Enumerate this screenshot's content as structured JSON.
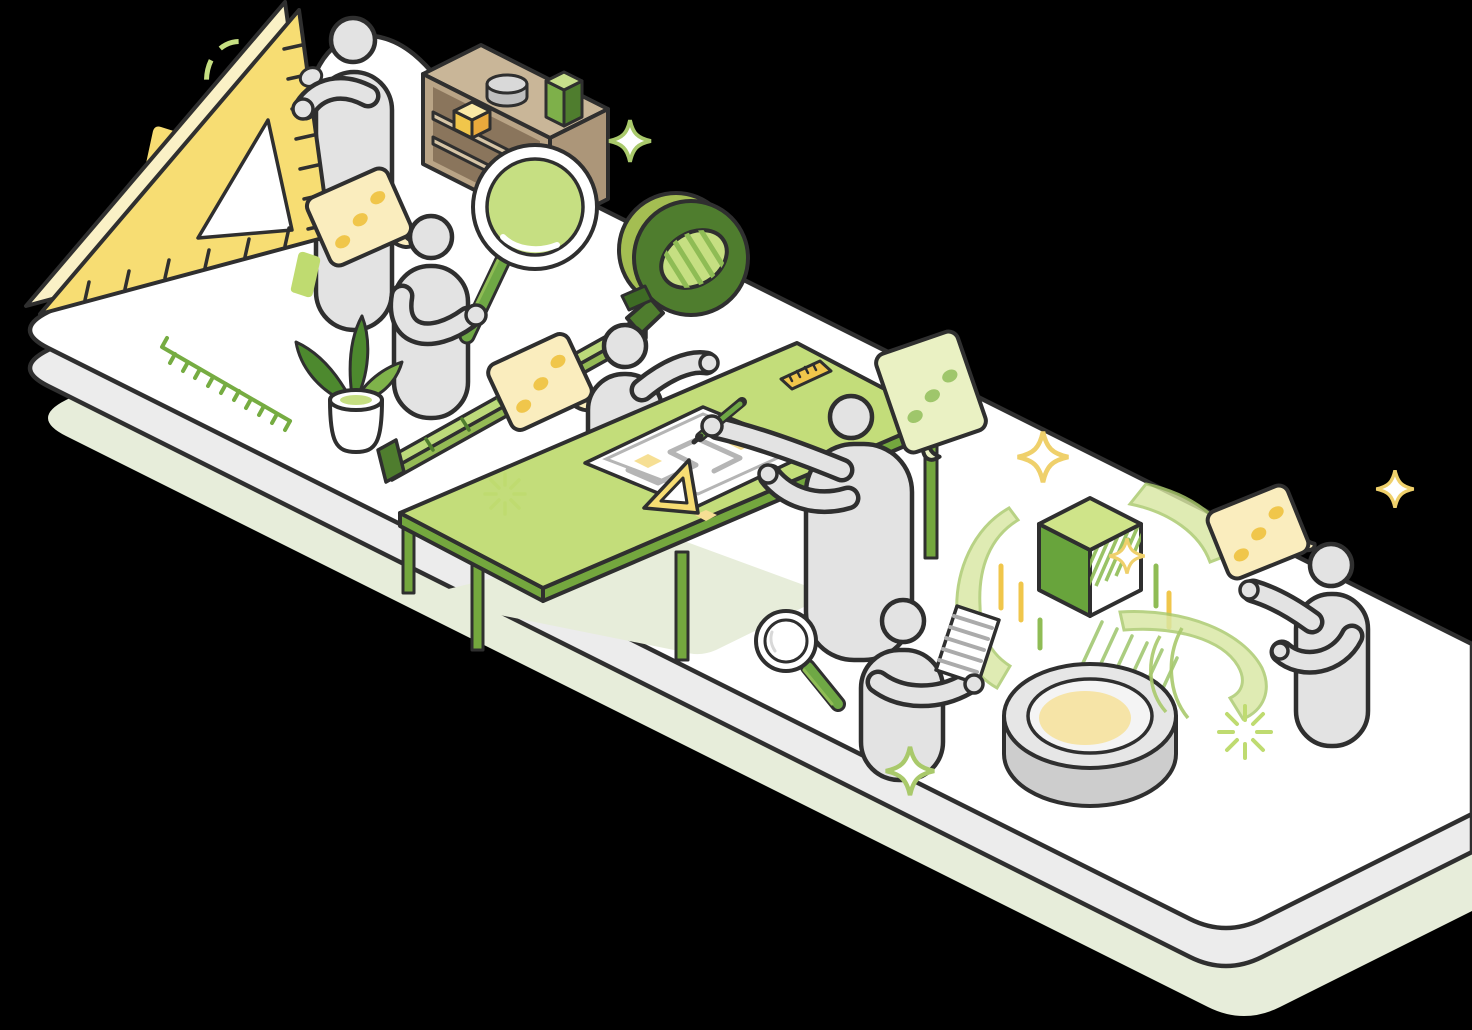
{
  "meta": {
    "type": "isometric-vector-illustration",
    "background_color": "#000000",
    "description": "Isometric illustration of a long white rounded platform on a pale sage shadow slab. Six gray faceless figures measure, inspect, draw and discuss: one holds a large yellow set-square, one holds a big green magnifying glass near a wooden shelf, one stands by a green measuring-tape dispenser with tape unrolled on the floor, one draws on a blueprint at a green drafting table, one reads a document beside a round gray 3D-scanner puck projecting a green cube with swirling arcs, and one talks at the right end. Yellow and green speech bubbles with dots, sparkles, a potted plant and small decorative shapes complete the scene."
  },
  "palette": {
    "ink": "#2F2F2F",
    "white": "#FFFFFF",
    "figure": "#E3E3E3",
    "platside": "#ECECEC",
    "sage": "#E7EDDA",
    "yellow": "#F7DD73",
    "cream": "#FAF1C6",
    "dotyellow": "#F0C64B",
    "cubeside": "#E9A93C",
    "bubbleyellow": "#FAEDBE",
    "glow": "#F6E4A7",
    "sparkyellow": "#EFD06B",
    "planyellow": "#F6DF94",
    "gdark": "#4F7D2E",
    "gmain": "#6FA845",
    "gmid": "#8FBC55",
    "glight": "#C6DF82",
    "gpale": "#DCE9A9",
    "gbubble": "#EAF1C3",
    "gdot": "#9FC66B",
    "gdeco": "#BFDB70",
    "bandgreen": "#A4BE52",
    "leafdark": "#4D892E",
    "leafmid": "#7FB34A",
    "tabletop": "#C3DD7A",
    "tableedge": "#74A73E",
    "arcfill": "#D9E7A3",
    "arcline": "#A9C96B",
    "tauptop": "#C9B698",
    "taupside": "#AC9679",
    "taupfront": "#B9A486",
    "taupint": "#8A755C",
    "board": "#D6C5A6",
    "cyl": "#BFBFBF",
    "cyltop": "#D9D9D9",
    "pucktop": "#E6E6E6",
    "puckside": "#CDCDCD",
    "ring": "#F4F4F4",
    "grayline": "#B5B5B5",
    "docline": "#ABABAB",
    "floorgreen": "#76AC42",
    "bg": "#000000"
  },
  "scene": {
    "objects": [
      {
        "name": "platform",
        "desc": "long isometric white slab with rounded corners, gray side, cut off at right edge"
      },
      {
        "name": "platform-shadow",
        "desc": "pale sage duplicate slab offset below"
      },
      {
        "name": "person-ruler-holder",
        "desc": "gray figure holding large yellow set-square with tick marks and triangular cutout"
      },
      {
        "name": "speech-bubble-1",
        "desc": "pale yellow tilted bubble, three yellow dots, tail bottom-right"
      },
      {
        "name": "dashed-circle",
        "desc": "light green dashed ellipse decoration, top left"
      },
      {
        "name": "yellow-card",
        "desc": "small flat yellow parallelogram decoration"
      },
      {
        "name": "green-card",
        "desc": "small flat green parallelogram decoration"
      },
      {
        "name": "shelf",
        "desc": "taupe open shelf; gray cylinder and green box on top, yellow cube inside"
      },
      {
        "name": "person-magnifier",
        "desc": "gray figure holding big magnifying glass with green lens and green handle"
      },
      {
        "name": "floor-scale",
        "desc": "green ruler tick line drawn on the platform floor"
      },
      {
        "name": "potted-plant",
        "desc": "white pot with dark and light green leaves"
      },
      {
        "name": "tape-measure",
        "desc": "green tape dispenser with hatched oval opening; light green tape with ticks unrolled to a dark end clip"
      },
      {
        "name": "speech-bubble-2",
        "desc": "pale yellow tilted bubble, three yellow dots"
      },
      {
        "name": "person-presenter",
        "desc": "gray figure gesturing toward the drafting table"
      },
      {
        "name": "drafting-table",
        "desc": "green table with darker edge and legs, sage shadow beneath"
      },
      {
        "name": "blueprint",
        "desc": "white sheets with gray floor-plan line and pale yellow patches"
      },
      {
        "name": "small-set-square",
        "desc": "small yellow triangle on the table"
      },
      {
        "name": "small-ruler",
        "desc": "small yellow ruler with ticks on the table"
      },
      {
        "name": "person-drafter",
        "desc": "gray figure drawing with a green pen"
      },
      {
        "name": "speech-bubble-green",
        "desc": "pale green bubble, three green dots, tail bottom-left"
      },
      {
        "name": "hand-magnifier",
        "desc": "small magnifying glass with green handle lying on the floor"
      },
      {
        "name": "person-reviewer",
        "desc": "gray figure reading a white document with gray lines"
      },
      {
        "name": "scanner-puck",
        "desc": "round gray device with white ring and soft yellow glowing center"
      },
      {
        "name": "hologram-cube",
        "desc": "green cube with hatched face and projection beam above the puck"
      },
      {
        "name": "motion-arcs",
        "desc": "three translucent light green swirl ribbons around cube and puck"
      },
      {
        "name": "dash-accents",
        "desc": "short vertical yellow and green dashes around the cube"
      },
      {
        "name": "person-speaker",
        "desc": "gray figure at right end, gesturing"
      },
      {
        "name": "speech-bubble-3",
        "desc": "pale yellow tilted bubble with yellow dots, tail toward speaker"
      },
      {
        "name": "sparkles",
        "desc": "four-point star outlines in yellow and green, plus two green ray bursts"
      }
    ]
  }
}
